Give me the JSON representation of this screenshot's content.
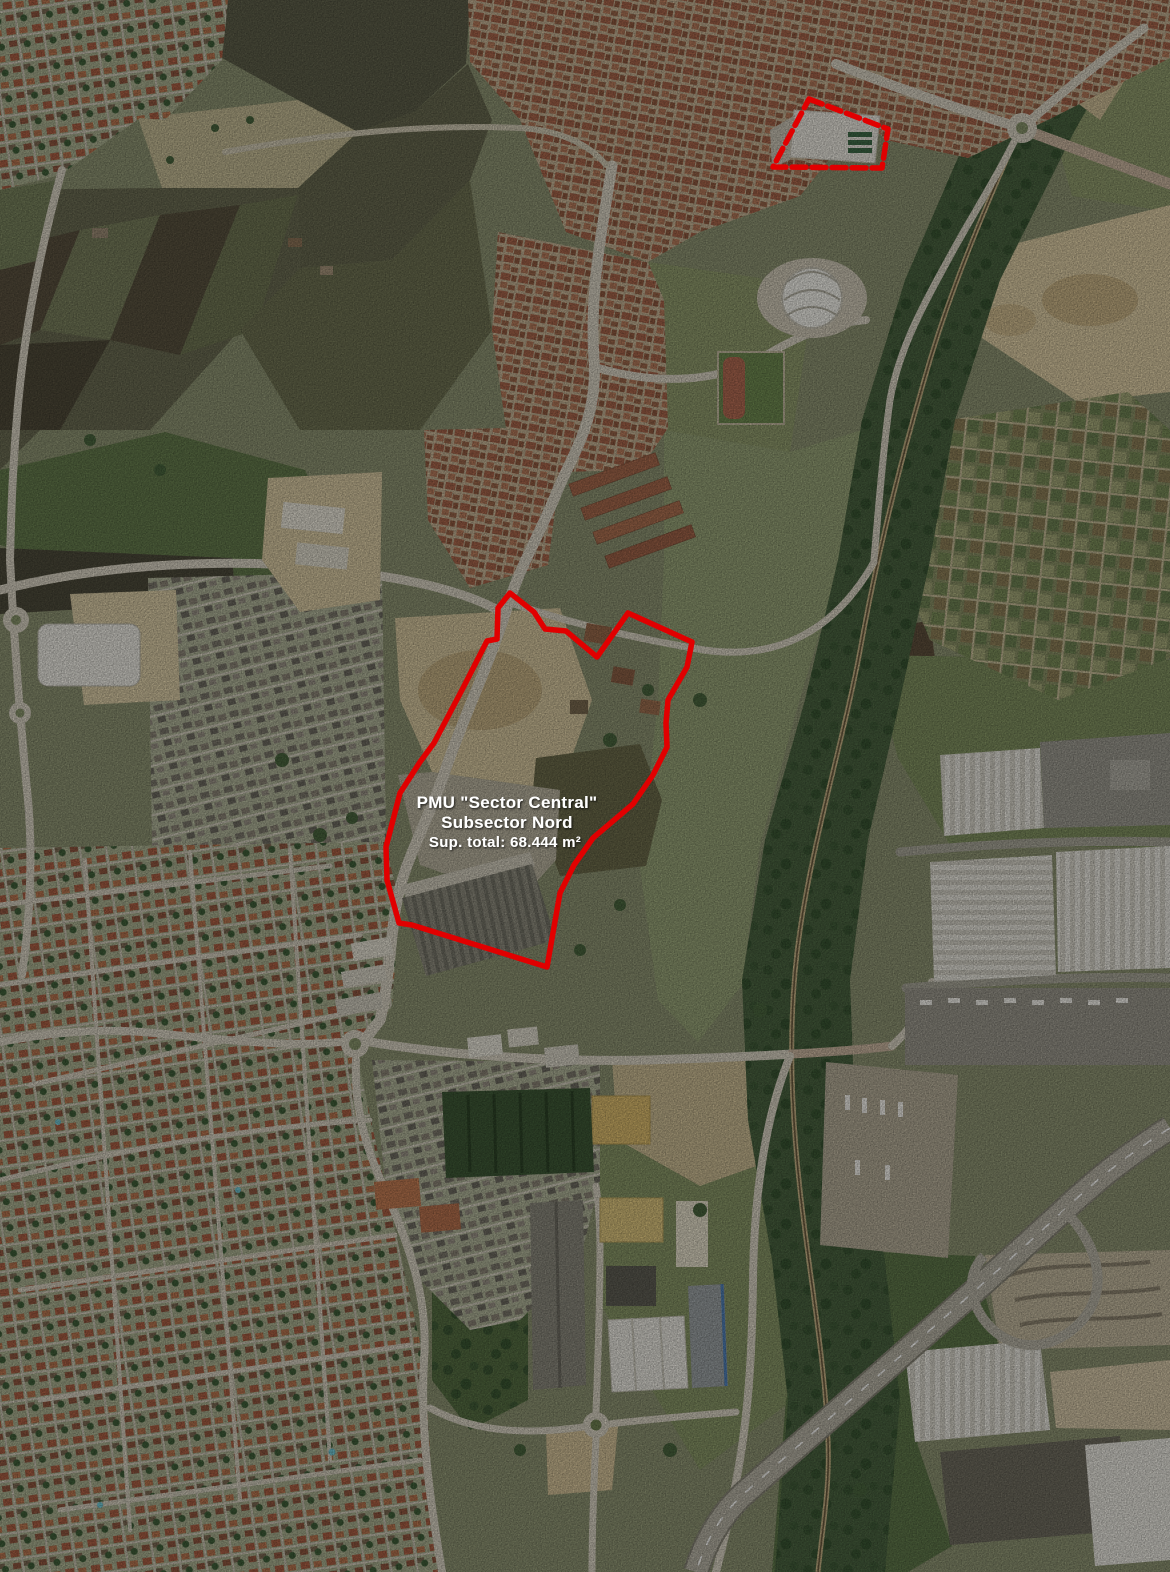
{
  "annotation": {
    "accent_color": "#e10000",
    "label": {
      "line1": "PMU \"Sector Central\"",
      "line2": "Subsector Nord",
      "area": "Sup. total: 68.444 m²"
    },
    "main_boundary_points": "510,593 534,612 545,629 566,631 597,657 628,613 692,642 687,667 668,700 666,723 667,747 653,775 633,804 593,838 574,865 560,893 554,927 547,967 412,925 399,923 387,880 386,847 400,793 420,762 434,743 463,688 487,641 497,639 498,608",
    "north_boundary_points": "809,99 888,129 882,168 773,167"
  }
}
